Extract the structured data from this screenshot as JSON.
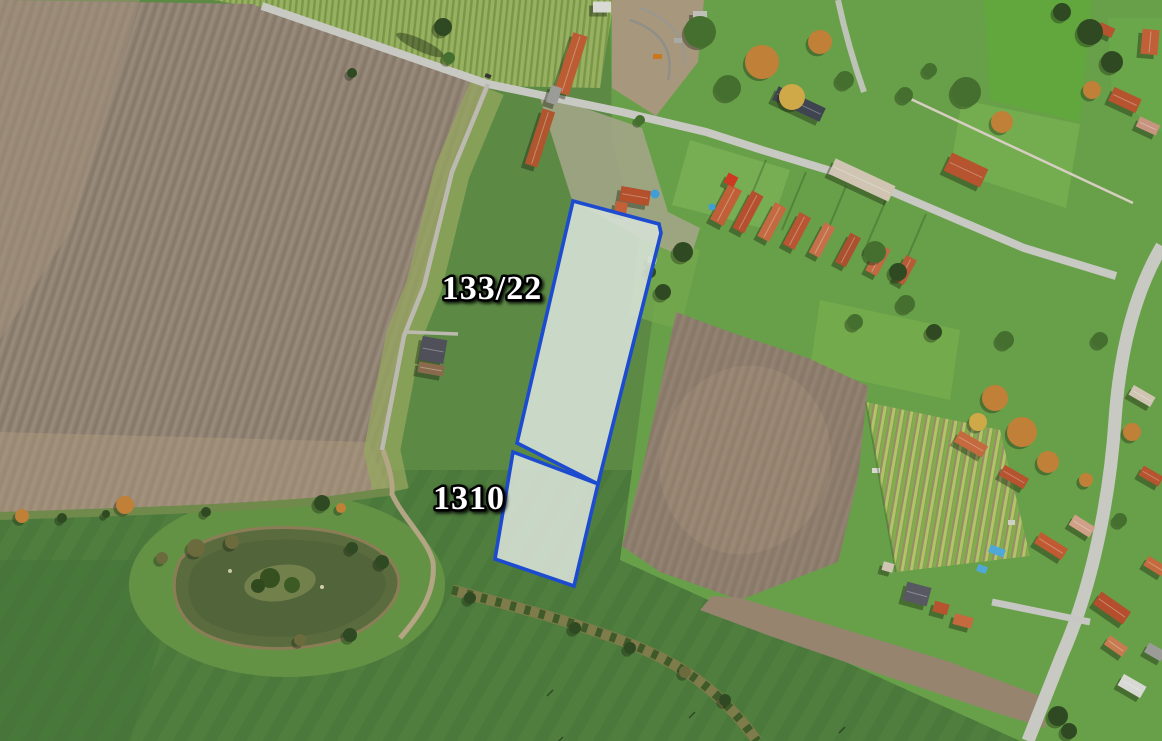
{
  "map": {
    "type": "aerial-cadastral-parcel-map",
    "parcels": [
      {
        "number": "133/22",
        "outline": "573,201 659,224 661,233 598,484 517,443",
        "label_x": 492,
        "label_y": 299
      },
      {
        "number": "1310",
        "outline": "513,452 598,484 574,586 495,559",
        "label_x": 469,
        "label_y": 509
      }
    ],
    "style": {
      "parcel_stroke": "#1d4bd0",
      "parcel_stroke_width": "3.6",
      "parcel_fill": "#d4ded2",
      "parcel_fill_opacity": "0.92",
      "label_color": "#ffffff",
      "label_outline": "#000000",
      "label_outline_width": "5"
    }
  }
}
